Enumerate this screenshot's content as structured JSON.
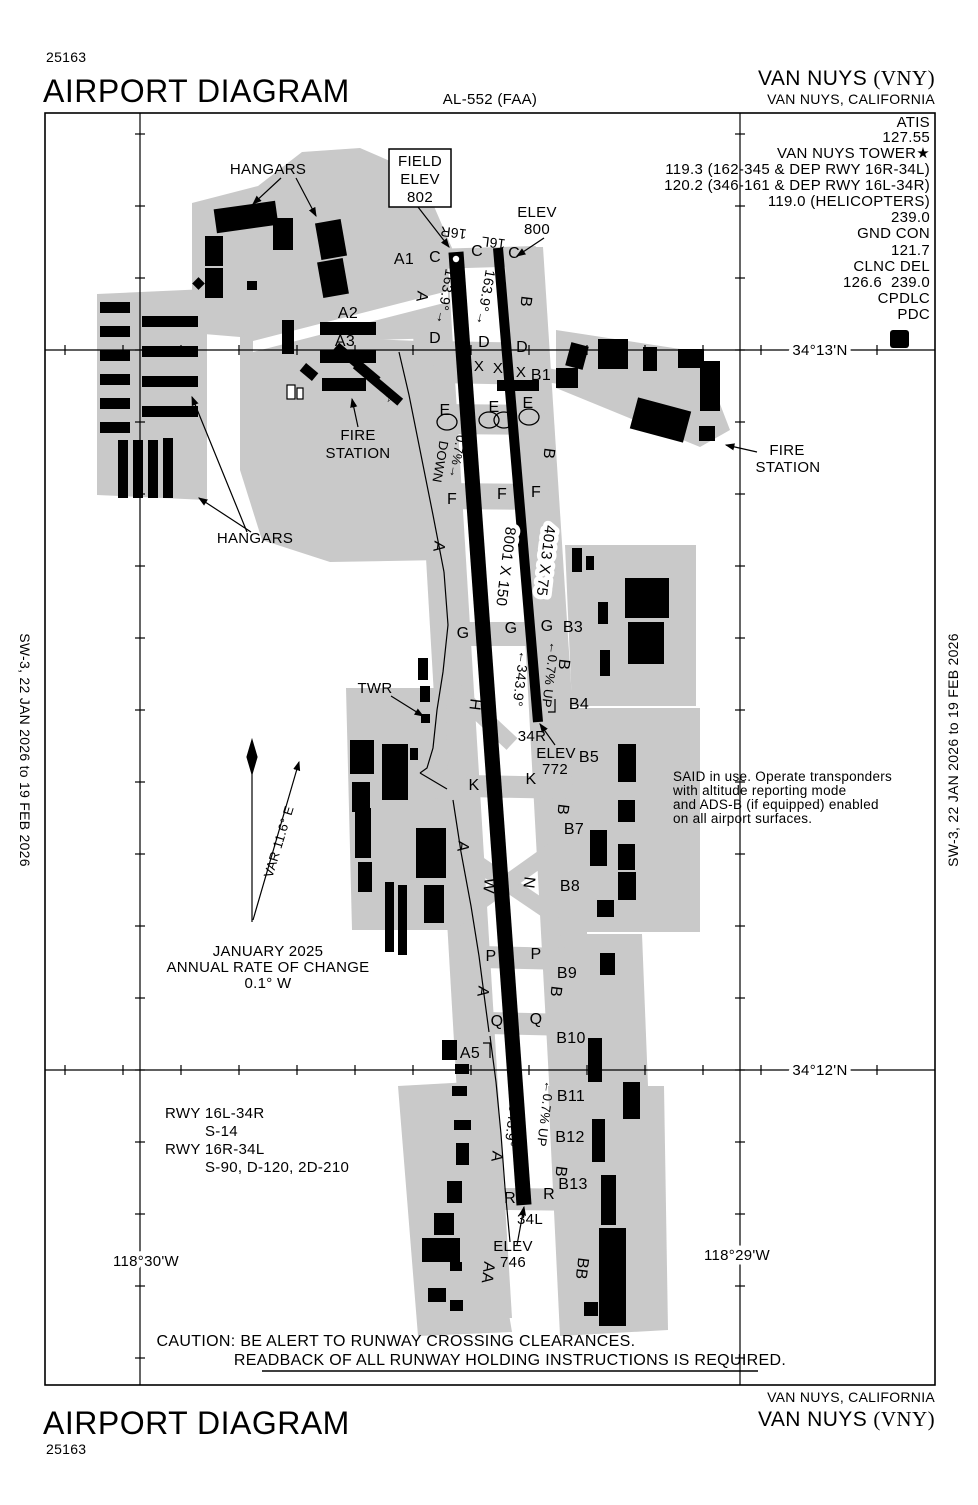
{
  "header": {
    "chart_number": "25163",
    "title": "AIRPORT DIAGRAM",
    "al_number": "AL-552 (FAA)",
    "airport_name": "VAN NUYS ",
    "airport_code": "(VNY)",
    "city": "VAN NUYS, CALIFORNIA"
  },
  "footer": {
    "title": "AIRPORT DIAGRAM",
    "chart_number": "25163",
    "city": "VAN NUYS, CALIFORNIA",
    "airport_name": "VAN NUYS ",
    "airport_code": "(VNY)"
  },
  "margins": {
    "left": "SW-3,  22 JAN 2026  to  19 FEB 2026",
    "right": "SW-3,  22 JAN 2026  to  19 FEB 2026"
  },
  "comm": {
    "lines": [
      "ATIS",
      "127.55",
      "VAN NUYS TOWER★",
      "119.3 (162-345 & DEP RWY 16R-34L)",
      "120.2 (346-161 & DEP RWY 16L-34R)",
      "119.0 (HELICOPTERS)",
      "239.0",
      "GND CON",
      "121.7",
      "CLNC DEL",
      "126.6  239.0",
      "CPDLC",
      "PDC"
    ],
    "d_symbol": "D"
  },
  "coords": {
    "lat_top": "34°13'N",
    "lat_bottom": "34°12'N",
    "lon_left": "118°30'W",
    "lon_right": "118°29'W"
  },
  "diagram": {
    "labels": [
      {
        "t": "34°13'N",
        "x": 820,
        "y": 355,
        "h": 1,
        "n": "lat-label-top"
      },
      {
        "t": "34°12'N",
        "x": 820,
        "y": 1075,
        "h": 1,
        "n": "lat-label-bottom"
      },
      {
        "t": "118°30'W",
        "x": 146,
        "y": 1266,
        "h": 1,
        "n": "lon-label-left"
      },
      {
        "t": "118°29'W",
        "x": 737,
        "y": 1260,
        "h": 1,
        "n": "lon-label-right"
      },
      {
        "t": "FIELD",
        "x": 420,
        "y": 166,
        "n": "field-elev-box-text"
      },
      {
        "t": "ELEV",
        "x": 420,
        "y": 184,
        "n": "field-elev-box-text"
      },
      {
        "t": "802",
        "x": 420,
        "y": 202,
        "n": "field-elev-box-text"
      },
      {
        "t": "ELEV",
        "x": 537,
        "y": 217,
        "n": "elev-800"
      },
      {
        "t": "800",
        "x": 537,
        "y": 234,
        "n": "elev-800"
      },
      {
        "t": "16R",
        "x": 454,
        "y": 228,
        "r": 187,
        "fs": 14,
        "n": "rwy-end-16r"
      },
      {
        "t": "16L",
        "x": 494,
        "y": 238,
        "r": 187,
        "fs": 14,
        "n": "rwy-end-16l"
      },
      {
        "t": "34R",
        "x": 532,
        "y": 741,
        "n": "rwy-end-34r"
      },
      {
        "t": "ELEV",
        "x": 556,
        "y": 758,
        "n": "elev-772"
      },
      {
        "t": "772",
        "x": 555,
        "y": 774,
        "n": "elev-772"
      },
      {
        "t": "34L",
        "x": 530,
        "y": 1224,
        "n": "rwy-end-34l"
      },
      {
        "t": "ELEV",
        "x": 513,
        "y": 1251,
        "n": "elev-746"
      },
      {
        "t": "746",
        "x": 513,
        "y": 1267,
        "n": "elev-746"
      },
      {
        "t": "HANGARS",
        "x": 268,
        "y": 174,
        "n": "hangars-label-north"
      },
      {
        "t": "HANGARS",
        "x": 255,
        "y": 543,
        "n": "hangars-label-west"
      },
      {
        "t": "FIRE",
        "x": 358,
        "y": 440,
        "n": "fire-station-label-west"
      },
      {
        "t": "STATION",
        "x": 358,
        "y": 458,
        "n": "fire-station-label-west"
      },
      {
        "t": "FIRE",
        "x": 787,
        "y": 455,
        "n": "fire-station-label-east"
      },
      {
        "t": "STATION",
        "x": 788,
        "y": 472,
        "n": "fire-station-label-east"
      },
      {
        "t": "TWR",
        "x": 375,
        "y": 693,
        "n": "tower-label"
      },
      {
        "t": "☆",
        "x": 391,
        "y": 402,
        "fs": 14,
        "n": "fire-station-star-icon"
      },
      {
        "t": "A1",
        "x": 404,
        "y": 264,
        "fs": 16
      },
      {
        "t": "A2",
        "x": 348,
        "y": 318,
        "fs": 16
      },
      {
        "t": "A3",
        "x": 345,
        "y": 346,
        "fs": 16
      },
      {
        "t": "A4",
        "x": 398,
        "y": 795,
        "fs": 16
      },
      {
        "t": "A5",
        "x": 470,
        "y": 1058,
        "fs": 16
      },
      {
        "t": "A",
        "x": 417,
        "y": 296,
        "r": 97,
        "fs": 16
      },
      {
        "t": "A",
        "x": 434,
        "y": 546,
        "r": 97,
        "fs": 16
      },
      {
        "t": "A",
        "x": 458,
        "y": 846,
        "r": 97,
        "fs": 16
      },
      {
        "t": "A",
        "x": 478,
        "y": 991,
        "r": 97,
        "fs": 16
      },
      {
        "t": "A",
        "x": 492,
        "y": 1156,
        "r": 97,
        "fs": 16
      },
      {
        "t": "B",
        "x": 521,
        "y": 301,
        "r": 97,
        "fs": 16
      },
      {
        "t": "B",
        "x": 544,
        "y": 453,
        "r": 97,
        "fs": 16
      },
      {
        "t": "B",
        "x": 559,
        "y": 664,
        "r": 97,
        "fs": 16
      },
      {
        "t": "B",
        "x": 558,
        "y": 809,
        "r": 97,
        "fs": 16
      },
      {
        "t": "B",
        "x": 551,
        "y": 991,
        "r": 97,
        "fs": 16
      },
      {
        "t": "B",
        "x": 556,
        "y": 1171,
        "r": 97,
        "fs": 16
      },
      {
        "t": "C",
        "x": 435,
        "y": 262,
        "fs": 16
      },
      {
        "t": "C",
        "x": 477,
        "y": 256,
        "fs": 16
      },
      {
        "t": "C",
        "x": 514,
        "y": 258,
        "fs": 16
      },
      {
        "t": "D",
        "x": 435,
        "y": 343,
        "fs": 16
      },
      {
        "t": "D",
        "x": 484,
        "y": 347,
        "fs": 16
      },
      {
        "t": "D",
        "x": 522,
        "y": 352,
        "fs": 16
      },
      {
        "t": "X",
        "x": 479,
        "y": 371,
        "fs": 15
      },
      {
        "t": "X",
        "x": 498,
        "y": 373,
        "fs": 15
      },
      {
        "t": "X",
        "x": 521,
        "y": 377,
        "fs": 15
      },
      {
        "t": "E",
        "x": 445,
        "y": 415,
        "fs": 16
      },
      {
        "t": "E",
        "x": 494,
        "y": 412,
        "fs": 16
      },
      {
        "t": "E",
        "x": 528,
        "y": 408,
        "fs": 16
      },
      {
        "t": "F",
        "x": 452,
        "y": 504,
        "fs": 16
      },
      {
        "t": "F",
        "x": 502,
        "y": 499,
        "fs": 16
      },
      {
        "t": "F",
        "x": 536,
        "y": 497,
        "fs": 16
      },
      {
        "t": "G",
        "x": 463,
        "y": 638,
        "fs": 16
      },
      {
        "t": "G",
        "x": 511,
        "y": 633,
        "fs": 16
      },
      {
        "t": "G",
        "x": 547,
        "y": 631,
        "fs": 16
      },
      {
        "t": "H",
        "x": 470,
        "y": 704,
        "r": 97,
        "fs": 16
      },
      {
        "t": "K",
        "x": 474,
        "y": 790,
        "fs": 16
      },
      {
        "t": "K",
        "x": 531,
        "y": 784,
        "fs": 16
      },
      {
        "t": "W",
        "x": 484,
        "y": 885,
        "r": 97,
        "fs": 16
      },
      {
        "t": "N",
        "x": 524,
        "y": 882,
        "r": 97,
        "fs": 16
      },
      {
        "t": "P",
        "x": 491,
        "y": 961,
        "fs": 16
      },
      {
        "t": "P",
        "x": 536,
        "y": 959,
        "fs": 16
      },
      {
        "t": "Q",
        "x": 497,
        "y": 1026,
        "fs": 16
      },
      {
        "t": "Q",
        "x": 536,
        "y": 1024,
        "fs": 16
      },
      {
        "t": "R",
        "x": 510,
        "y": 1203,
        "fs": 16
      },
      {
        "t": "R",
        "x": 549,
        "y": 1199,
        "fs": 16
      },
      {
        "t": "AA",
        "x": 483,
        "y": 1272,
        "r": 97,
        "fs": 16
      },
      {
        "t": "BB",
        "x": 577,
        "y": 1268,
        "r": 97,
        "fs": 16
      },
      {
        "t": "B1",
        "x": 541,
        "y": 380,
        "fs": 16
      },
      {
        "t": "B3",
        "x": 573,
        "y": 632,
        "fs": 16
      },
      {
        "t": "B4",
        "x": 579,
        "y": 709,
        "fs": 16
      },
      {
        "t": "B5",
        "x": 589,
        "y": 762,
        "fs": 16
      },
      {
        "t": "B7",
        "x": 574,
        "y": 834,
        "fs": 16
      },
      {
        "t": "B8",
        "x": 570,
        "y": 891,
        "fs": 16
      },
      {
        "t": "B9",
        "x": 567,
        "y": 978,
        "fs": 16
      },
      {
        "t": "B10",
        "x": 571,
        "y": 1043,
        "fs": 16
      },
      {
        "t": "B11",
        "x": 571,
        "y": 1101,
        "fs": 16
      },
      {
        "t": "B12",
        "x": 570,
        "y": 1142,
        "fs": 16
      },
      {
        "t": "B13",
        "x": 573,
        "y": 1189,
        "fs": 16
      },
      {
        "t": "163.9°→",
        "x": 441,
        "y": 296,
        "r": 100,
        "fs": 14,
        "n": "rwy-heading-16r"
      },
      {
        "t": "163.9°→",
        "x": 481,
        "y": 297,
        "r": 100,
        "fs": 14,
        "n": "rwy-heading-16l"
      },
      {
        "t": "0.7%→",
        "x": 453,
        "y": 456,
        "r": 100,
        "fs": 13,
        "n": "rwy-slope"
      },
      {
        "t": "DOWN",
        "x": 436,
        "y": 461,
        "r": 100,
        "fs": 13,
        "n": "rwy-slope"
      },
      {
        "t": "8001 X 150",
        "x": 501,
        "y": 566,
        "r": 97,
        "fs": 15,
        "h": 1,
        "n": "rwy-dimensions-16r-34l"
      },
      {
        "t": "4013 X 75",
        "x": 541,
        "y": 560,
        "r": 97,
        "fs": 15,
        "h": 1,
        "n": "rwy-dimensions-16l-34r"
      },
      {
        "t": "←343.9°",
        "x": 516,
        "y": 678,
        "r": 97,
        "fs": 14,
        "n": "rwy-heading-34r"
      },
      {
        "t": "←0.7% UP",
        "x": 546,
        "y": 674,
        "r": 97,
        "fs": 13,
        "n": "rwy-slope"
      },
      {
        "t": "←343.9°",
        "x": 508,
        "y": 1118,
        "r": 97,
        "fs": 14,
        "n": "rwy-heading-34l"
      },
      {
        "t": "←0.7% UP",
        "x": 541,
        "y": 1113,
        "r": 97,
        "fs": 13,
        "n": "rwy-slope"
      },
      {
        "t": "VAR 11.6° E",
        "x": 283,
        "y": 843,
        "r": -73,
        "fs": 13,
        "n": "magnetic-variation"
      },
      {
        "t": "JANUARY 2025",
        "x": 268,
        "y": 956,
        "n": "variation-note"
      },
      {
        "t": "ANNUAL RATE OF CHANGE",
        "x": 268,
        "y": 972,
        "n": "variation-note"
      },
      {
        "t": "0.1° W",
        "x": 268,
        "y": 988,
        "n": "variation-note"
      },
      {
        "t": "SAID in use. Operate transponders",
        "x": 673,
        "y": 781,
        "a": "start",
        "fs": 13.5,
        "n": "said-note"
      },
      {
        "t": "with altitude reporting mode",
        "x": 673,
        "y": 795,
        "a": "start",
        "fs": 13.5,
        "n": "said-note"
      },
      {
        "t": "and ADS-B (if equipped) enabled",
        "x": 673,
        "y": 809,
        "a": "start",
        "fs": 13.5,
        "n": "said-note"
      },
      {
        "t": "on all airport surfaces.",
        "x": 673,
        "y": 823,
        "a": "start",
        "fs": 13.5,
        "n": "said-note"
      },
      {
        "t": "RWY 16L-34R",
        "x": 165,
        "y": 1118,
        "a": "start",
        "n": "rwy-data"
      },
      {
        "t": "S-14",
        "x": 205,
        "y": 1136,
        "a": "start",
        "n": "rwy-data"
      },
      {
        "t": "RWY 16R-34L",
        "x": 165,
        "y": 1154,
        "a": "start",
        "n": "rwy-data"
      },
      {
        "t": "S-90, D-120, 2D-210",
        "x": 205,
        "y": 1172,
        "a": "start",
        "n": "rwy-data"
      },
      {
        "t": "CAUTION: BE ALERT TO RUNWAY CROSSING CLEARANCES.",
        "x": 396,
        "y": 1346,
        "fs": 16,
        "n": "caution-note"
      },
      {
        "t": "READBACK OF ALL RUNWAY HOLDING INSTRUCTIONS IS REQUIRED.",
        "x": 510,
        "y": 1365,
        "fs": 16,
        "n": "caution-note"
      }
    ]
  }
}
